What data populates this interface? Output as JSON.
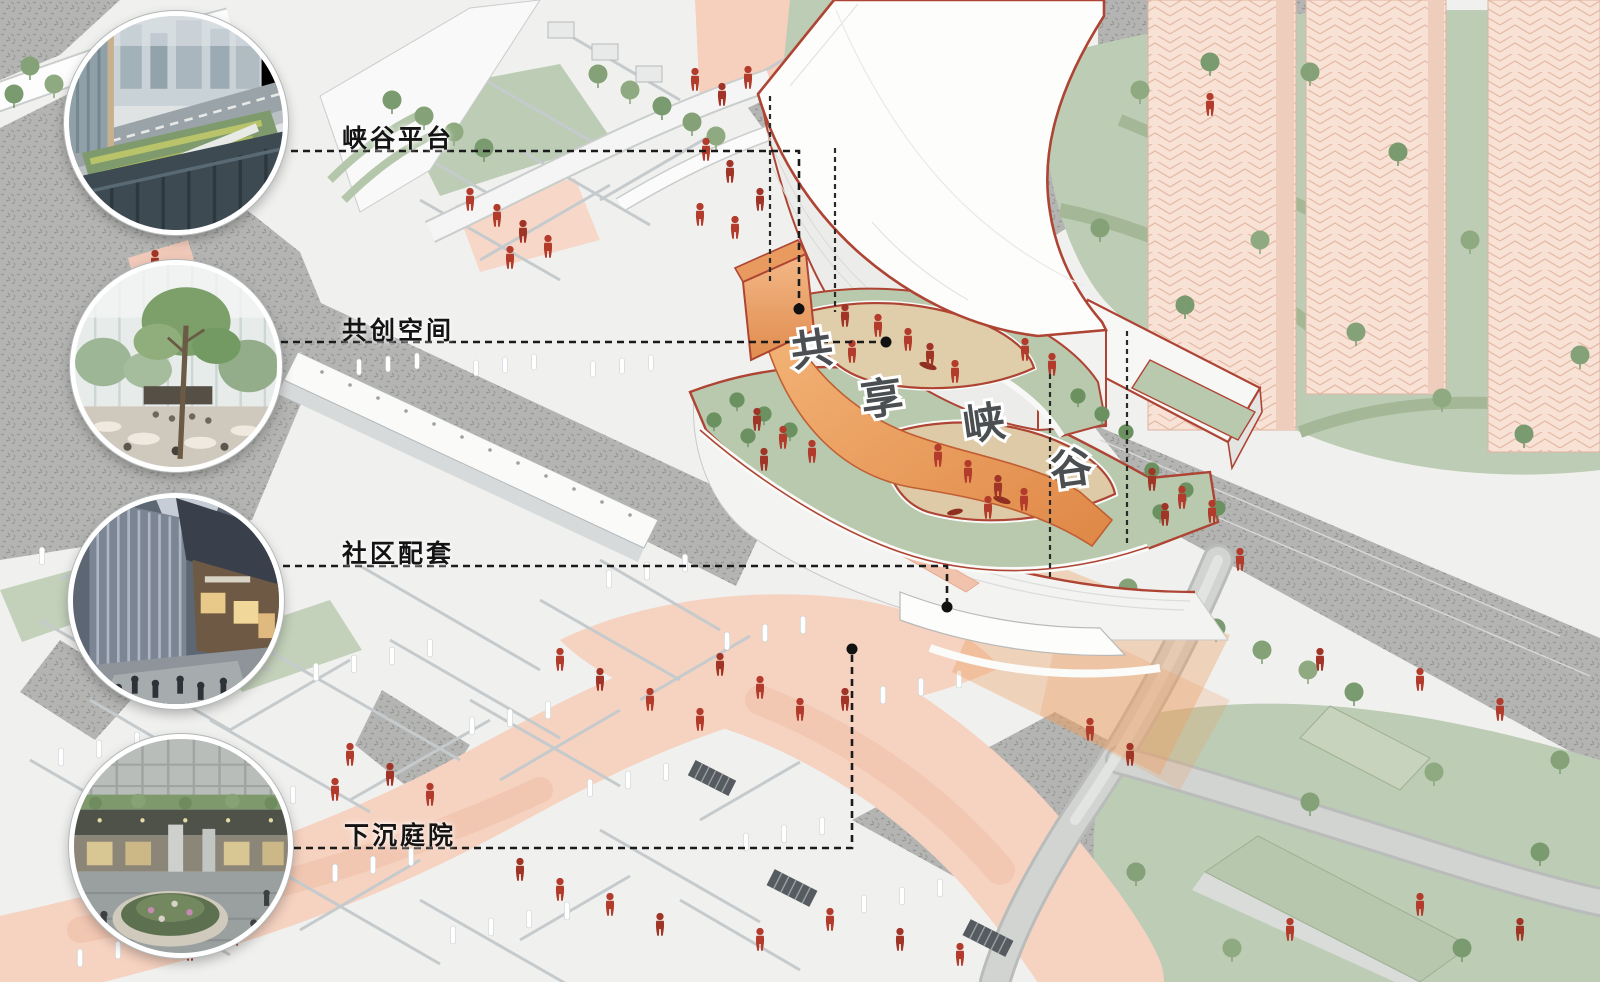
{
  "page": {
    "width": 1600,
    "height": 982,
    "background": "#f6f7f5"
  },
  "title": {
    "text": "共享峡谷",
    "characters": [
      "共",
      "享",
      "峡",
      "谷"
    ]
  },
  "callouts": [
    {
      "id": "canyon-platform",
      "label": "峡谷平台",
      "photo": "rooftop-canyon-platform-photo"
    },
    {
      "id": "cocreation-space",
      "label": "共创空间",
      "photo": "indoor-atrium-cocreation-photo"
    },
    {
      "id": "community-retail",
      "label": "社区配套",
      "photo": "community-retail-street-photo"
    },
    {
      "id": "sunken-courtyard",
      "label": "下沉庭院",
      "photo": "sunken-courtyard-plaza-photo"
    }
  ],
  "palette": {
    "accent_red_outline": "#ae4433",
    "people_red": "#b23b2c",
    "salmon_street": "#f6d2c0",
    "sage_green": "#bdccb4",
    "deck_green": "#b9c9ae",
    "tan_plaza": "#decaa6",
    "canyon_orange": "#e8945c",
    "tower_pink": "#f8e1d5",
    "road_gray": "#b4b5b3",
    "ink": "#1b1b1b"
  }
}
